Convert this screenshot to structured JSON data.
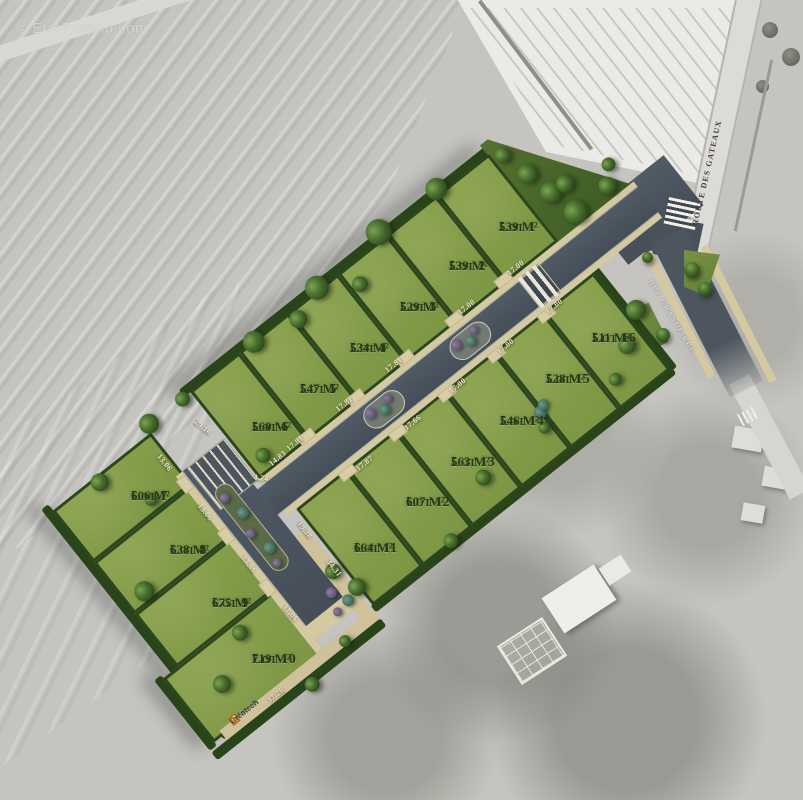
{
  "watermark": "© EtreProprio.com",
  "branding": {
    "logo_text": "Créatech"
  },
  "streets": {
    "route": "ROUTE DES GATEAUX",
    "rue": "RUE GRANDE RUE"
  },
  "lots": [
    {
      "label": "Lot 1",
      "area": "539 M²"
    },
    {
      "label": "Lot 2",
      "area": "539 M²"
    },
    {
      "label": "Lot 3",
      "area": "529 M²"
    },
    {
      "label": "Lot 4",
      "area": "534 M²"
    },
    {
      "label": "Lot 5",
      "area": "547 M²"
    },
    {
      "label": "Lot 6",
      "area": "560 M²"
    },
    {
      "label": "Lot 7",
      "area": "606 M²"
    },
    {
      "label": "Lot 8",
      "area": "638 M²"
    },
    {
      "label": "Lot 9",
      "area": "675 M²"
    },
    {
      "label": "Lot 10",
      "area": "719 M²"
    },
    {
      "label": "Lot 11",
      "area": "664 M²"
    },
    {
      "label": "Lot 12",
      "area": "607 M²"
    },
    {
      "label": "Lot 13",
      "area": "563 M²"
    },
    {
      "label": "Lot 14",
      "area": "546 M²"
    },
    {
      "label": "Lot 15",
      "area": "528 M²"
    },
    {
      "label": "Lot 16",
      "area": "511 M²"
    }
  ],
  "dims": [
    "17.00",
    "17.00",
    "17.81",
    "17.81",
    "17.81",
    "14.83",
    "4.24",
    "29.16",
    "17.00",
    "17.00",
    "17.00",
    "17.66",
    "17.87",
    "13.06",
    "13.06",
    "13.06",
    "11.06",
    "37.26",
    "34.31",
    "19.38"
  ],
  "colors": {
    "lot_green": "#87a04b",
    "hedge_green": "#2c471b",
    "road_slate": "#49525c",
    "sidewalk_tan": "#d5c9a2",
    "aerial_gray": "#c5c4c0",
    "logo_orange": "#e8922b"
  },
  "icons": {
    "tree-icon": "dark-green radial circle",
    "bush-icon": "purple/teal radial circle",
    "crosswalk-icon": "white striped rectangle"
  }
}
